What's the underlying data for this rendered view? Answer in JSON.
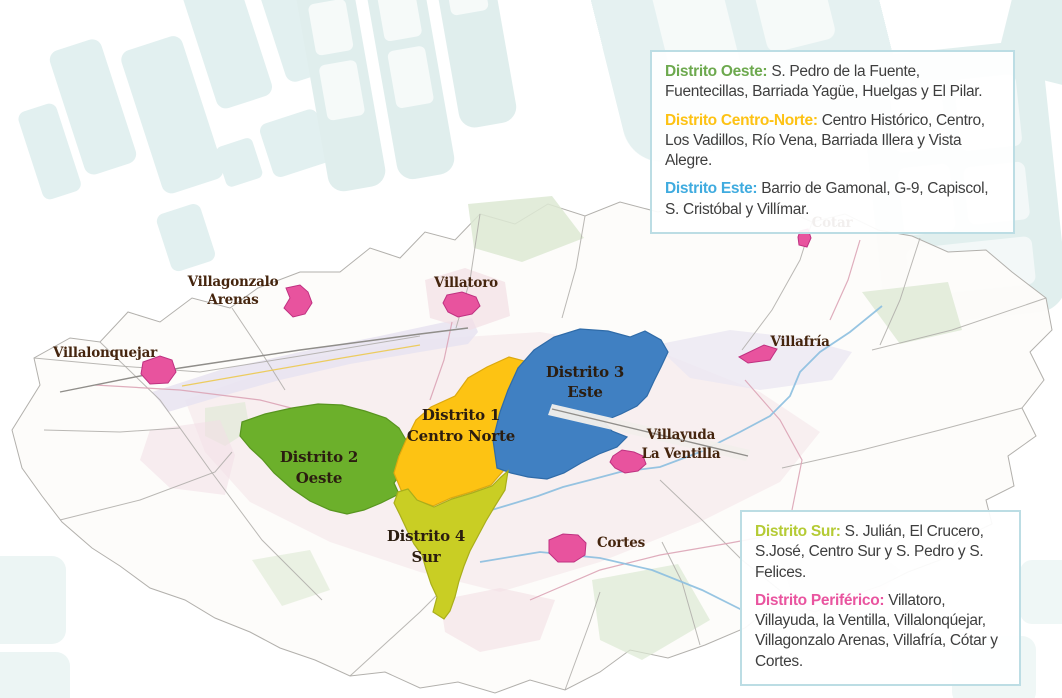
{
  "legend_top": {
    "items": [
      {
        "label": "Distrito Oeste:",
        "text": " S. Pedro de la Fuente, Fuentecillas, Barriada Yagüe, Huelgas y El Pilar.",
        "color": "#6da94e"
      },
      {
        "label": "Distrito Centro-Norte:",
        "text": " Centro Histórico, Centro, Los Vadillos, Río Vena, Barriada Illera y Vista Alegre.",
        "color": "#fdc214"
      },
      {
        "label": "Distrito Este:",
        "text": " Barrio de Gamonal, G-9, Capiscol, S. Cristóbal y Villímar.",
        "color": "#3fabdf"
      }
    ]
  },
  "legend_bottom": {
    "items": [
      {
        "label": "Distrito Sur:",
        "text": " S. Julián, El Crucero, S.José, Centro Sur y S. Pedro y S. Felices.",
        "color": "#b5cb35"
      },
      {
        "label": "Distrito Periférico:",
        "text": " Villatoro, Villayuda, la Ventilla, Villalonqúejar, Villagonzalo Arenas, Villafría, Cótar y Cortes.",
        "color": "#e9549f"
      }
    ]
  },
  "map": {
    "districts": [
      {
        "line1": "Distrito 1",
        "line2": "Centro Norte",
        "color": "#fdc313"
      },
      {
        "line1": "Distrito 2",
        "line2": "Oeste",
        "color": "#6cb02b"
      },
      {
        "line1": "Distrito 3",
        "line2": "Este",
        "color": "#4080c2"
      },
      {
        "line1": "Distrito 4",
        "line2": "Sur",
        "color": "#c9ce24"
      }
    ],
    "villages": [
      {
        "line1": "Villalonquejar"
      },
      {
        "line1": "Villagonzalo",
        "line2": "Arenas"
      },
      {
        "line1": "Villatoro"
      },
      {
        "line1": "Cotar"
      },
      {
        "line1": "Villafría"
      },
      {
        "line1": "Villayuda",
        "line2": "La Ventilla"
      },
      {
        "line1": "Cortes"
      }
    ],
    "village_fill": "#e8539e",
    "label_color": "#45250e"
  }
}
